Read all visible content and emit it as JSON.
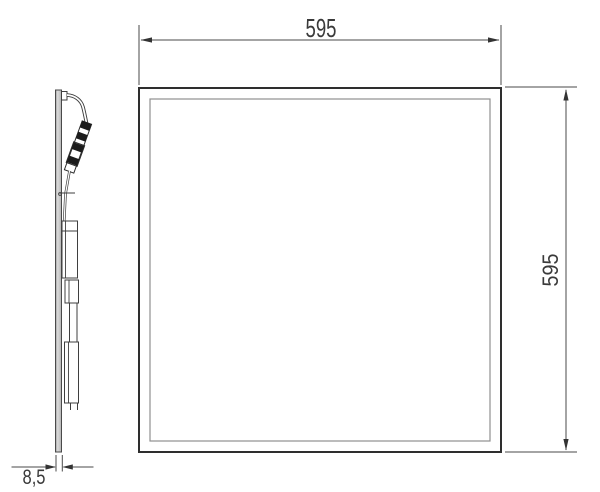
{
  "drawing": {
    "dimensions": {
      "width": "595",
      "height": "595",
      "thickness": "8,5"
    },
    "colors": {
      "background": "#ffffff",
      "dimension_line": "#4a4a4a",
      "text": "#3a3a3a",
      "panel_frame": "#2e2e2e",
      "panel_inner_frame": "#8f8f8f",
      "side_profile_fill": "#cbcbcb",
      "connector_band": "#1c1c1c"
    }
  }
}
